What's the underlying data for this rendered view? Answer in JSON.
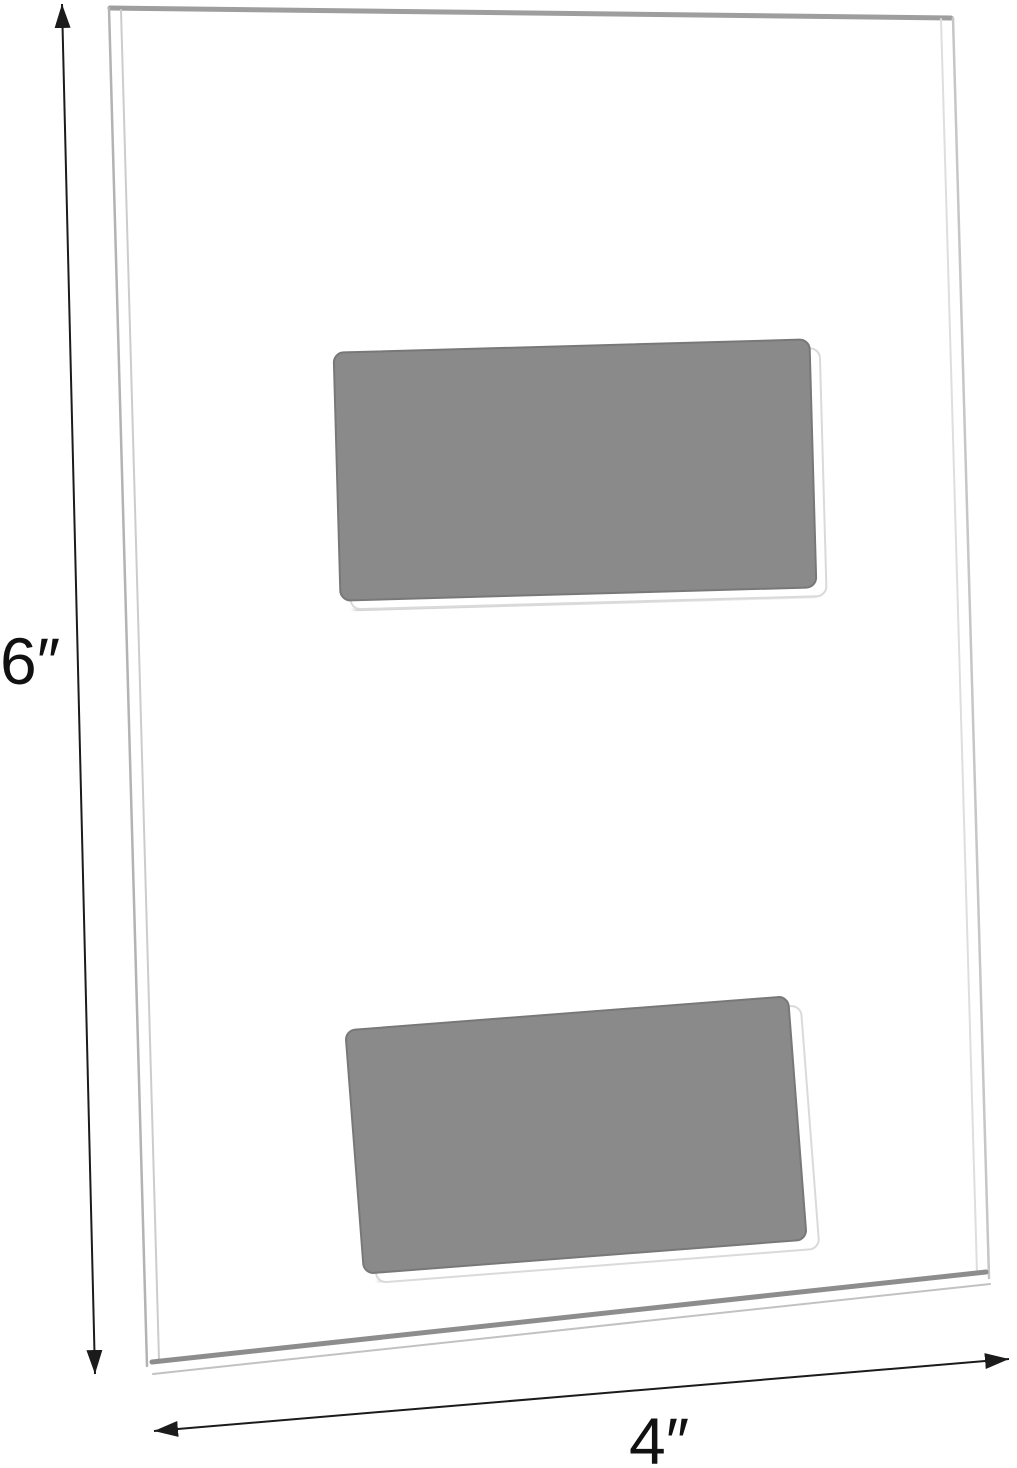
{
  "diagram": {
    "height_label": "6″",
    "width_label": "4″"
  },
  "colors": {
    "background": "#ffffff",
    "dimension_line": "#1b1b1b",
    "arrowhead": "#1b1b1b",
    "pad_fill": "#8a8a8a",
    "pad_border": "#787878",
    "pad_backing_edge": "#dadada",
    "panel_top_edge": "#9e9e9e",
    "panel_side_edge_outer": "#b3b3b3",
    "panel_side_edge_inner": "#cccccc",
    "panel_right_edge_outer": "#c6c6c6",
    "panel_right_edge_inner": "#dedede",
    "panel_bottom_edge_dark": "#8d8d8d",
    "panel_bottom_edge_outer": "#c2c2c2"
  }
}
